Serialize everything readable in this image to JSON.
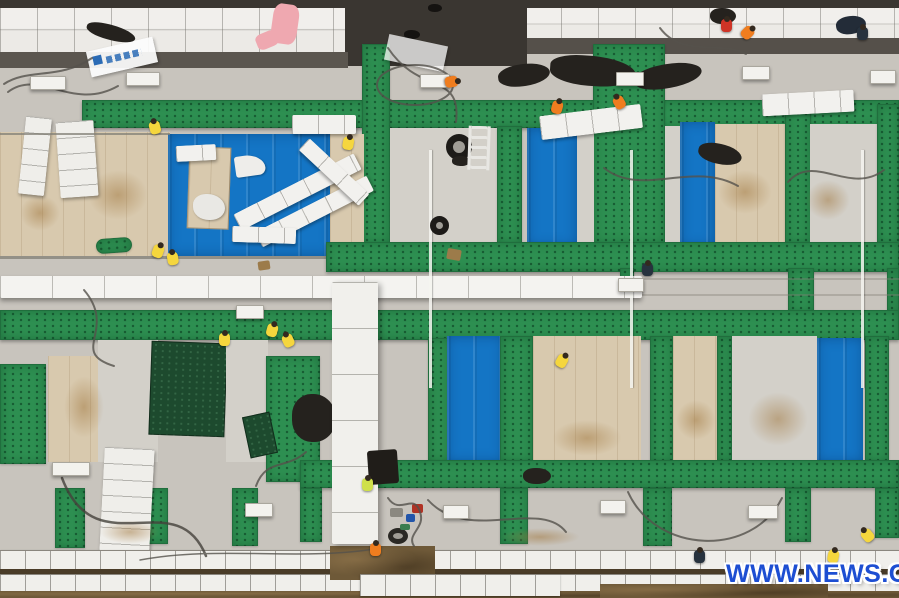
{
  "watermark": {
    "text": "WWW.NEWS.CN"
  },
  "colors": {
    "asphalt": "#3a3631",
    "white_panel": "#eceae6",
    "concrete": "#c8c4bd",
    "concrete_light": "#d3d0c9",
    "green": "#2d8f51",
    "green_cloth": "#1d4a2e",
    "blue": "#1475c5",
    "beige": "#d8c9ae",
    "dirt": "#6e5938",
    "white_block": "#f0efeb",
    "black_cloth": "#25221e",
    "pink": "#efa8b0",
    "banner_blue": "#2b6bb5",
    "watermark": "#1d4ed2",
    "vest_yellow": "#f5d63d",
    "vest_lime": "#cfe04a",
    "vest_orange": "#ef7d1f",
    "vest_red": "#cf3426",
    "vest_navy": "#27323e"
  },
  "workers": [
    {
      "x": 148,
      "y": 118,
      "vest": "vest_yellow",
      "rot": -15
    },
    {
      "x": 342,
      "y": 134,
      "vest": "vest_yellow",
      "rot": 10
    },
    {
      "x": 446,
      "y": 74,
      "vest": "vest_orange",
      "rot": 80
    },
    {
      "x": 551,
      "y": 98,
      "vest": "vest_orange",
      "rot": 15
    },
    {
      "x": 612,
      "y": 93,
      "vest": "vest_orange",
      "rot": -30
    },
    {
      "x": 720,
      "y": 16,
      "vest": "vest_red",
      "rot": 0
    },
    {
      "x": 742,
      "y": 24,
      "vest": "vest_orange",
      "rot": 45
    },
    {
      "x": 856,
      "y": 24,
      "vest": "vest_navy",
      "rot": 0
    },
    {
      "x": 152,
      "y": 242,
      "vest": "vest_yellow",
      "rot": 20
    },
    {
      "x": 166,
      "y": 249,
      "vest": "vest_yellow",
      "rot": -10
    },
    {
      "x": 218,
      "y": 330,
      "vest": "vest_yellow",
      "rot": 0
    },
    {
      "x": 266,
      "y": 321,
      "vest": "vest_yellow",
      "rot": 15
    },
    {
      "x": 281,
      "y": 331,
      "vest": "vest_yellow",
      "rot": -25
    },
    {
      "x": 556,
      "y": 352,
      "vest": "vest_yellow",
      "rot": 30
    },
    {
      "x": 641,
      "y": 260,
      "vest": "vest_navy",
      "rot": 0
    },
    {
      "x": 361,
      "y": 475,
      "vest": "vest_lime",
      "rot": 0
    },
    {
      "x": 369,
      "y": 540,
      "vest": "vest_orange",
      "rot": 0
    },
    {
      "x": 693,
      "y": 547,
      "vest": "vest_navy",
      "rot": 0
    },
    {
      "x": 860,
      "y": 526,
      "vest": "vest_yellow",
      "rot": -40
    },
    {
      "x": 827,
      "y": 547,
      "vest": "vest_yellow",
      "rot": 10
    }
  ],
  "vents": [
    {
      "x": 30,
      "y": 76,
      "w": 36
    },
    {
      "x": 126,
      "y": 72,
      "w": 34
    },
    {
      "x": 420,
      "y": 74,
      "w": 30
    },
    {
      "x": 616,
      "y": 72,
      "w": 28
    },
    {
      "x": 742,
      "y": 66,
      "w": 28
    },
    {
      "x": 870,
      "y": 70,
      "w": 26
    },
    {
      "x": 618,
      "y": 278,
      "w": 26
    },
    {
      "x": 236,
      "y": 305,
      "w": 28
    },
    {
      "x": 52,
      "y": 462,
      "w": 38
    },
    {
      "x": 245,
      "y": 503,
      "w": 28
    },
    {
      "x": 443,
      "y": 505,
      "w": 26
    },
    {
      "x": 600,
      "y": 500,
      "w": 26
    },
    {
      "x": 748,
      "y": 505,
      "w": 30
    }
  ]
}
